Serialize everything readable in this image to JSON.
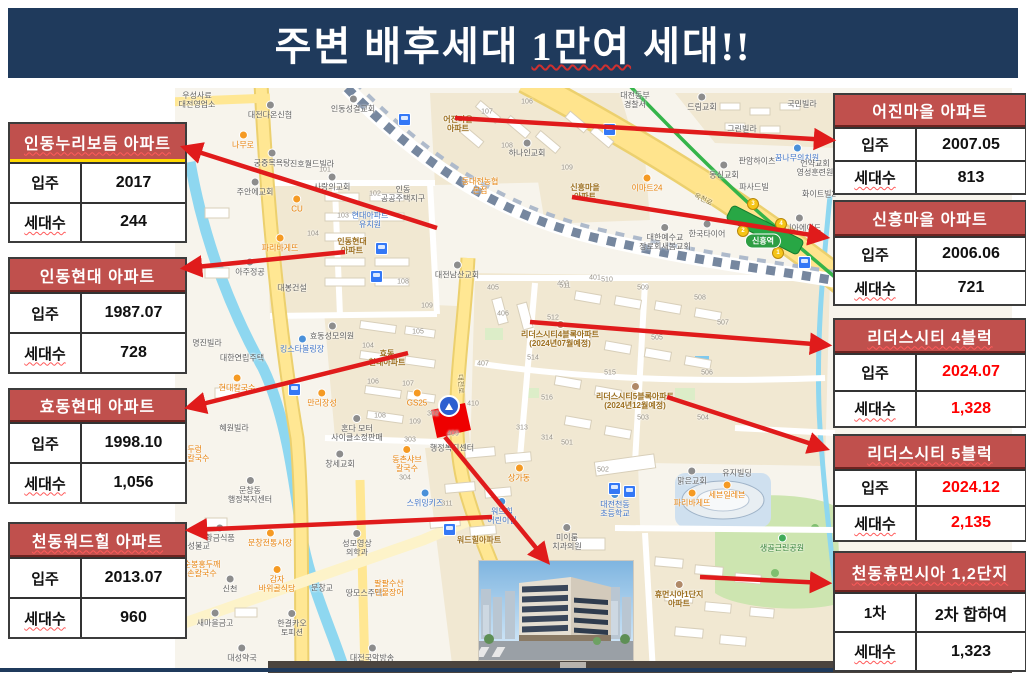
{
  "banner": {
    "title_part1": "주변 배후세대 ",
    "title_wavy": "1만여",
    "title_part2": " 세대!!",
    "bg_color": "#1f3a5c"
  },
  "accent": {
    "header_red": "#c0504d",
    "arrow_red": "#e01b1b",
    "site_red": "#ee0000",
    "value_red": "#ff0000"
  },
  "tables": {
    "left": [
      {
        "name": "인동누리보듬 아파트",
        "wavy": true,
        "vc": "#111111",
        "rows": [
          {
            "label": "입주",
            "value": "2017"
          },
          {
            "label": "세대수",
            "value": "244"
          }
        ]
      },
      {
        "name": "인동현대 아파트",
        "wavy": false,
        "vc": "#111111",
        "rows": [
          {
            "label": "입주",
            "value": "1987.07"
          },
          {
            "label": "세대수",
            "value": "728"
          }
        ]
      },
      {
        "name": "효동현대 아파트",
        "wavy": false,
        "vc": "#111111",
        "rows": [
          {
            "label": "입주",
            "value": "1998.10"
          },
          {
            "label": "세대수",
            "value": "1,056"
          }
        ]
      },
      {
        "name": "천동워드힐 아파트",
        "wavy": true,
        "vc": "#111111",
        "rows": [
          {
            "label": "입주",
            "value": "2013.07"
          },
          {
            "label": "세대수",
            "value": "960"
          }
        ]
      }
    ],
    "right": [
      {
        "name": "어진마을 아파트",
        "wavy": false,
        "vc": "#111111",
        "rows": [
          {
            "label": "입주",
            "value": "2007.05"
          },
          {
            "label": "세대수",
            "value": "813"
          }
        ]
      },
      {
        "name": "신흥마을 아파트",
        "wavy": false,
        "vc": "#111111",
        "rows": [
          {
            "label": "입주",
            "value": "2006.06"
          },
          {
            "label": "세대수",
            "value": "721"
          }
        ]
      },
      {
        "name": "리더스시티 4블럭",
        "wavy": true,
        "vc": "#ff0000",
        "rows": [
          {
            "label": "입주",
            "value": "2024.07"
          },
          {
            "label": "세대수",
            "value": "1,328"
          }
        ]
      },
      {
        "name": "리더스시티 5블럭",
        "wavy": true,
        "vc": "#ff0000",
        "rows": [
          {
            "label": "입주",
            "value": "2024.12"
          },
          {
            "label": "세대수",
            "value": "2,135"
          }
        ]
      },
      {
        "name": "천동휴먼시아 1,2단지",
        "wavy": true,
        "vc": "#111111",
        "rows": [
          {
            "label": "1차",
            "value": "2차 합하여"
          },
          {
            "label": "세대수",
            "value": "1,323"
          }
        ]
      }
    ]
  },
  "map": {
    "station": "신흥역",
    "labels": [
      {
        "t": "우성사료\n대전영업소",
        "x": 22,
        "y": 12,
        "c": "g"
      },
      {
        "t": "대전다온신협",
        "x": 95,
        "y": 22,
        "c": "g",
        "d": 1
      },
      {
        "t": "인동성결교회",
        "x": 178,
        "y": 16,
        "c": "g",
        "d": 1
      },
      {
        "t": "대전동부\n경찰서",
        "x": 460,
        "y": 12,
        "c": "g"
      },
      {
        "t": "어진마을\n아파트",
        "x": 283,
        "y": 36,
        "c": "a"
      },
      {
        "t": "나무로",
        "x": 68,
        "y": 52,
        "c": "o",
        "d": 1
      },
      {
        "t": "궁중목욕탕",
        "x": 97,
        "y": 70,
        "c": "g",
        "d": 1
      },
      {
        "t": "하나인교회",
        "x": 352,
        "y": 60,
        "c": "g",
        "d": 1
      },
      {
        "t": "진호월드빌라",
        "x": 137,
        "y": 76,
        "c": "g"
      },
      {
        "t": "드림교회",
        "x": 527,
        "y": 14,
        "c": "g",
        "d": 1
      },
      {
        "t": "국민빌라",
        "x": 627,
        "y": 16,
        "c": "g"
      },
      {
        "t": "그린빌라",
        "x": 567,
        "y": 41,
        "c": "g"
      },
      {
        "t": "꿈나무의치원",
        "x": 622,
        "y": 65,
        "c": "b",
        "d": 1
      },
      {
        "t": "판암하이츠",
        "x": 582,
        "y": 73,
        "c": "g"
      },
      {
        "t": "주안에교회",
        "x": 80,
        "y": 99,
        "c": "g",
        "d": 1
      },
      {
        "t": "사랑의교회",
        "x": 157,
        "y": 94,
        "c": "g",
        "d": 1
      },
      {
        "t": "동대전농협\n본점",
        "x": 305,
        "y": 98,
        "c": "o"
      },
      {
        "t": "이마트24",
        "x": 472,
        "y": 95,
        "c": "o",
        "d": 1
      },
      {
        "t": "동신교회",
        "x": 549,
        "y": 82,
        "c": "g",
        "d": 1
      },
      {
        "t": "언약교회\n영성훈련원",
        "x": 640,
        "y": 80,
        "c": "g"
      },
      {
        "t": "파사드빌",
        "x": 579,
        "y": 99,
        "c": "g"
      },
      {
        "t": "화이트빌2",
        "x": 644,
        "y": 106,
        "c": "g"
      },
      {
        "t": "인동\n공공주택지구",
        "x": 228,
        "y": 106,
        "c": "g"
      },
      {
        "t": "신흥마을\n아파트",
        "x": 410,
        "y": 104,
        "c": "a"
      },
      {
        "t": "CU",
        "x": 122,
        "y": 116,
        "c": "o",
        "d": 1
      },
      {
        "t": "현대아파트\n유치원",
        "x": 195,
        "y": 132,
        "c": "b"
      },
      {
        "t": "위니아에이드",
        "x": 624,
        "y": 135,
        "c": "g",
        "d": 1
      },
      {
        "t": "한국타이어",
        "x": 532,
        "y": 141,
        "c": "g",
        "d": 1
      },
      {
        "t": "파리바게뜨",
        "x": 105,
        "y": 155,
        "c": "o",
        "d": 1
      },
      {
        "t": "인동현대\n아파트",
        "x": 177,
        "y": 158,
        "c": "a"
      },
      {
        "t": "대한예수교\n장로회새봄교회",
        "x": 490,
        "y": 149,
        "c": "g",
        "d": 1
      },
      {
        "t": "아주정공",
        "x": 75,
        "y": 179,
        "c": "g",
        "d": 1
      },
      {
        "t": "대전남산교회",
        "x": 282,
        "y": 182,
        "c": "g",
        "d": 1
      },
      {
        "t": "대봉건설",
        "x": 117,
        "y": 200,
        "c": "g"
      },
      {
        "t": "명진빌라",
        "x": 32,
        "y": 255,
        "c": "g"
      },
      {
        "t": "효동성모의원",
        "x": 157,
        "y": 243,
        "c": "g",
        "d": 1
      },
      {
        "t": "킹스타볼링장",
        "x": 127,
        "y": 256,
        "c": "b",
        "d": 1
      },
      {
        "t": "대한연립주택",
        "x": 67,
        "y": 270,
        "c": "g"
      },
      {
        "t": "리더스시티4블록아파트\n(2024년07월예정)",
        "x": 385,
        "y": 246,
        "c": "a",
        "d": 1
      },
      {
        "t": "효동\n현대아파트",
        "x": 212,
        "y": 270,
        "c": "a"
      },
      {
        "t": "현대칼국수",
        "x": 62,
        "y": 295,
        "c": "o",
        "d": 1
      },
      {
        "t": "만리장성",
        "x": 147,
        "y": 310,
        "c": "o",
        "d": 1
      },
      {
        "t": "GS25",
        "x": 242,
        "y": 310,
        "c": "o",
        "d": 1
      },
      {
        "t": "리더스시티5블록아파트\n(2024년12월예정)",
        "x": 460,
        "y": 308,
        "c": "a",
        "d": 1
      },
      {
        "t": "혜원빌라",
        "x": 59,
        "y": 340,
        "c": "g"
      },
      {
        "t": "혼다 모터\n사이클소정판매",
        "x": 182,
        "y": 340,
        "c": "g",
        "d": 1
      },
      {
        "t": "행정복지센터",
        "x": 277,
        "y": 360,
        "c": "g"
      },
      {
        "t": "창세교회",
        "x": 165,
        "y": 371,
        "c": "g",
        "d": 1
      },
      {
        "t": "동촌샤브\n칼국수",
        "x": 232,
        "y": 371,
        "c": "o",
        "d": 1
      },
      {
        "t": "논두렁\n추어칼국수",
        "x": 16,
        "y": 366,
        "c": "o"
      },
      {
        "t": "상가동",
        "x": 344,
        "y": 385,
        "c": "o",
        "d": 1
      },
      {
        "t": "맑은교회",
        "x": 517,
        "y": 388,
        "c": "g",
        "d": 1
      },
      {
        "t": "유지빌딩",
        "x": 562,
        "y": 385,
        "c": "g"
      },
      {
        "t": "세븐일레븐",
        "x": 552,
        "y": 402,
        "c": "o",
        "d": 1
      },
      {
        "t": "파리바게뜨",
        "x": 517,
        "y": 410,
        "c": "o",
        "d": 1
      },
      {
        "t": "문창동\n행정복지센터",
        "x": 75,
        "y": 402,
        "c": "g",
        "d": 1
      },
      {
        "t": "스위밍키즈",
        "x": 250,
        "y": 410,
        "c": "b",
        "d": 1
      },
      {
        "t": "워드힐\n어린이집",
        "x": 327,
        "y": 423,
        "c": "b",
        "d": 1
      },
      {
        "t": "대전천동\n초등학교",
        "x": 440,
        "y": 416,
        "c": "b",
        "d": 1
      },
      {
        "t": "미이룸\n치과의원",
        "x": 392,
        "y": 449,
        "c": "g",
        "d": 1
      },
      {
        "t": "생골근린공원",
        "x": 607,
        "y": 455,
        "c": "p",
        "d": 1
      },
      {
        "t": "문창전통시장",
        "x": 95,
        "y": 450,
        "c": "o",
        "d": 1
      },
      {
        "t": "황금식품",
        "x": 45,
        "y": 445,
        "c": "g",
        "d": 1
      },
      {
        "t": "운성불교",
        "x": 20,
        "y": 458,
        "c": "g"
      },
      {
        "t": "워드힐아파트",
        "x": 304,
        "y": 452,
        "c": "a"
      },
      {
        "t": "성모영상\n의학과",
        "x": 182,
        "y": 455,
        "c": "g",
        "d": 1
      },
      {
        "t": "순봉홍두깨\n손칼국수",
        "x": 27,
        "y": 481,
        "c": "o"
      },
      {
        "t": "감자\n바위골식당",
        "x": 102,
        "y": 491,
        "c": "o",
        "d": 1
      },
      {
        "t": "신천",
        "x": 55,
        "y": 496,
        "c": "g",
        "d": 1
      },
      {
        "t": "문창교",
        "x": 147,
        "y": 500,
        "c": "g"
      },
      {
        "t": "땅모스주택",
        "x": 189,
        "y": 505,
        "c": "g"
      },
      {
        "t": "팔팔수산\n민물장어",
        "x": 214,
        "y": 500,
        "c": "o"
      },
      {
        "t": "휴먼시아1단지\n아파트",
        "x": 504,
        "y": 506,
        "c": "a",
        "d": 1
      },
      {
        "t": "새마을금고",
        "x": 40,
        "y": 530,
        "c": "g",
        "d": 1
      },
      {
        "t": "한결카오\n토피션",
        "x": 117,
        "y": 535,
        "c": "g",
        "d": 1
      },
      {
        "t": "대성약국",
        "x": 67,
        "y": 565,
        "c": "g",
        "d": 1
      },
      {
        "t": "대전국악방송",
        "x": 197,
        "y": 565,
        "c": "g",
        "d": 1
      },
      {
        "t": "옥천로",
        "x": 528,
        "y": 112,
        "c": "rd",
        "r": 26
      },
      {
        "t": "대전로",
        "x": 285,
        "y": 296,
        "c": "rd",
        "r": 87
      }
    ],
    "numbers": [
      [
        "106",
        352,
        14
      ],
      [
        "107",
        312,
        24
      ],
      [
        "108",
        332,
        58
      ],
      [
        "109",
        392,
        80
      ],
      [
        "101",
        150,
        82
      ],
      [
        "102",
        200,
        106
      ],
      [
        "103",
        168,
        128
      ],
      [
        "104",
        138,
        146
      ],
      [
        "108",
        228,
        194
      ],
      [
        "109",
        252,
        218
      ],
      [
        "105",
        243,
        244
      ],
      [
        "104",
        193,
        258
      ],
      [
        "106",
        198,
        294
      ],
      [
        "107",
        233,
        296
      ],
      [
        "108",
        205,
        328
      ],
      [
        "109",
        240,
        334
      ],
      [
        "405",
        318,
        200
      ],
      [
        "406",
        328,
        226
      ],
      [
        "402",
        388,
        196
      ],
      [
        "401",
        420,
        190
      ],
      [
        "407",
        308,
        276
      ],
      [
        "410",
        298,
        316
      ],
      [
        "409",
        278,
        346
      ],
      [
        "511",
        390,
        198
      ],
      [
        "510",
        432,
        192
      ],
      [
        "509",
        468,
        200
      ],
      [
        "508",
        525,
        210
      ],
      [
        "512",
        378,
        230
      ],
      [
        "505",
        482,
        250
      ],
      [
        "507",
        548,
        235
      ],
      [
        "514",
        358,
        270
      ],
      [
        "515",
        435,
        285
      ],
      [
        "516",
        372,
        310
      ],
      [
        "506",
        532,
        285
      ],
      [
        "503",
        468,
        330
      ],
      [
        "504",
        528,
        330
      ],
      [
        "501",
        392,
        355
      ],
      [
        "502",
        428,
        382
      ],
      [
        "302",
        258,
        326
      ],
      [
        "313",
        347,
        340
      ],
      [
        "314",
        372,
        350
      ],
      [
        "311",
        272,
        416
      ],
      [
        "303",
        235,
        352
      ],
      [
        "304",
        230,
        390
      ]
    ],
    "bus_stops": [
      [
        205,
        159
      ],
      [
        200,
        187
      ],
      [
        228,
        30
      ],
      [
        433,
        40
      ],
      [
        628,
        173
      ],
      [
        438,
        399
      ],
      [
        453,
        402
      ],
      [
        118,
        300
      ],
      [
        273,
        440
      ]
    ],
    "big_markers": [
      [
        272,
        316
      ]
    ],
    "exits": [
      [
        577,
        115,
        "3"
      ],
      [
        605,
        135,
        "4"
      ],
      [
        567,
        142,
        "2"
      ],
      [
        602,
        164,
        "1"
      ]
    ],
    "station_pos": [
      588,
      153
    ],
    "arrows": [
      {
        "x1": 437,
        "y1": 228,
        "x2": 186,
        "y2": 148
      },
      {
        "x1": 345,
        "y1": 252,
        "x2": 186,
        "y2": 268
      },
      {
        "x1": 408,
        "y1": 353,
        "x2": 190,
        "y2": 407
      },
      {
        "x1": 492,
        "y1": 517,
        "x2": 191,
        "y2": 530
      },
      {
        "x1": 455,
        "y1": 118,
        "x2": 830,
        "y2": 140
      },
      {
        "x1": 572,
        "y1": 197,
        "x2": 824,
        "y2": 237
      },
      {
        "x1": 530,
        "y1": 322,
        "x2": 826,
        "y2": 345
      },
      {
        "x1": 667,
        "y1": 397,
        "x2": 824,
        "y2": 448
      },
      {
        "x1": 700,
        "y1": 577,
        "x2": 826,
        "y2": 583
      },
      {
        "x1": 445,
        "y1": 437,
        "x2": 546,
        "y2": 560
      }
    ]
  }
}
